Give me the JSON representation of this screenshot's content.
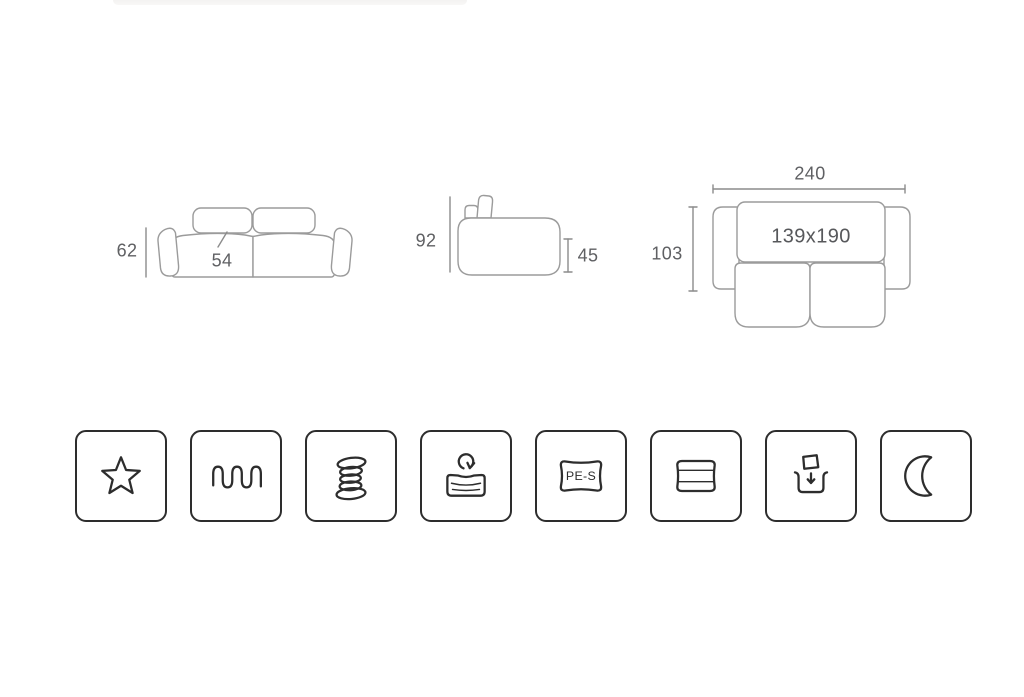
{
  "colors": {
    "background": "#ffffff",
    "drawing_stroke": "#9b9b9b",
    "dimension_line": "#8c8c8c",
    "dimension_text": "#5f6063",
    "icon_stroke": "#2d2d2d",
    "top_strip": "#f6f5f4"
  },
  "dimension_diagrams": {
    "front_view": {
      "overall_height": "62",
      "seat_depth": "54"
    },
    "side_view": {
      "overall_height": "92",
      "seat_height": "45"
    },
    "top_view": {
      "overall_width": "240",
      "overall_depth": "103",
      "bed_size": "139x190"
    }
  },
  "feature_icons": [
    {
      "name": "star-icon"
    },
    {
      "name": "wave-springs-icon"
    },
    {
      "name": "coil-springs-icon"
    },
    {
      "name": "elastic-mattress-icon"
    },
    {
      "name": "pes-foam-icon",
      "label": "PE-S"
    },
    {
      "name": "layered-foam-icon"
    },
    {
      "name": "bedding-storage-icon"
    },
    {
      "name": "sleep-function-icon"
    }
  ]
}
